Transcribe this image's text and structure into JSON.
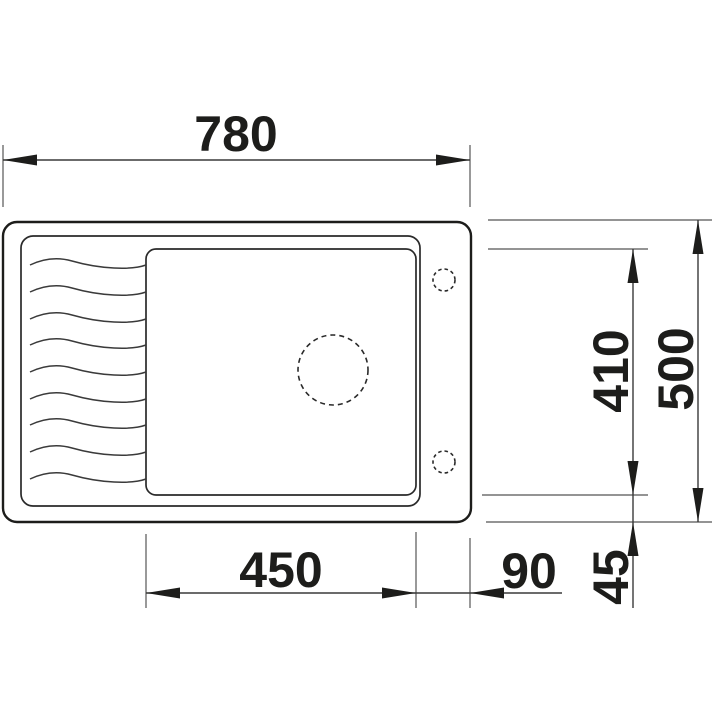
{
  "drawing": {
    "type": "sink-top-view-dimension-drawing",
    "background_color": "#ffffff",
    "line_color": "#1d1d1b",
    "labels": {
      "total_width": "780",
      "total_depth": "500",
      "bowl_width": "450",
      "bowl_depth": "410",
      "right_offset": "90",
      "bottom_offset": "45"
    }
  }
}
